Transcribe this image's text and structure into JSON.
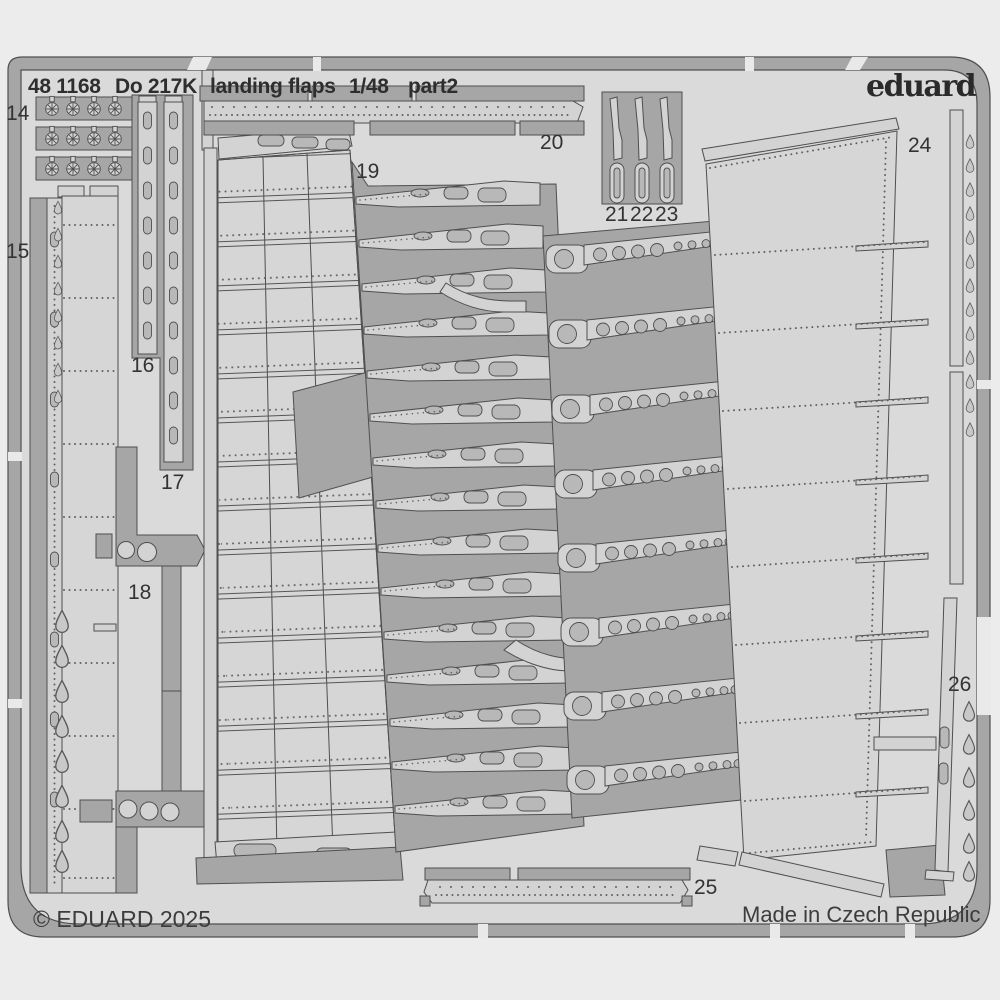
{
  "header": {
    "catalog": "48 1168",
    "model": "Do 217K",
    "subject": "landing flaps",
    "scale": "1/48",
    "sheet": "part2"
  },
  "brand": {
    "logo": "eduard"
  },
  "footer": {
    "copyright": "© EDUARD 2025",
    "origin": "Made in Czech Republic"
  },
  "parts": {
    "p14": "14",
    "p15": "15",
    "p16": "16",
    "p17": "17",
    "p18": "18",
    "p19": "19",
    "p20": "20",
    "p21": "21",
    "p22": "22",
    "p23": "23",
    "p24": "24",
    "p25": "25",
    "p26": "26"
  },
  "colors": {
    "background": "#ececec",
    "sheet": "#dadada",
    "frame": "#a6a6a6",
    "part_light": "#d3d3d3",
    "hole": "#b8b8b8",
    "outline": "#4f4f4f",
    "text": "#2e2e2e"
  }
}
